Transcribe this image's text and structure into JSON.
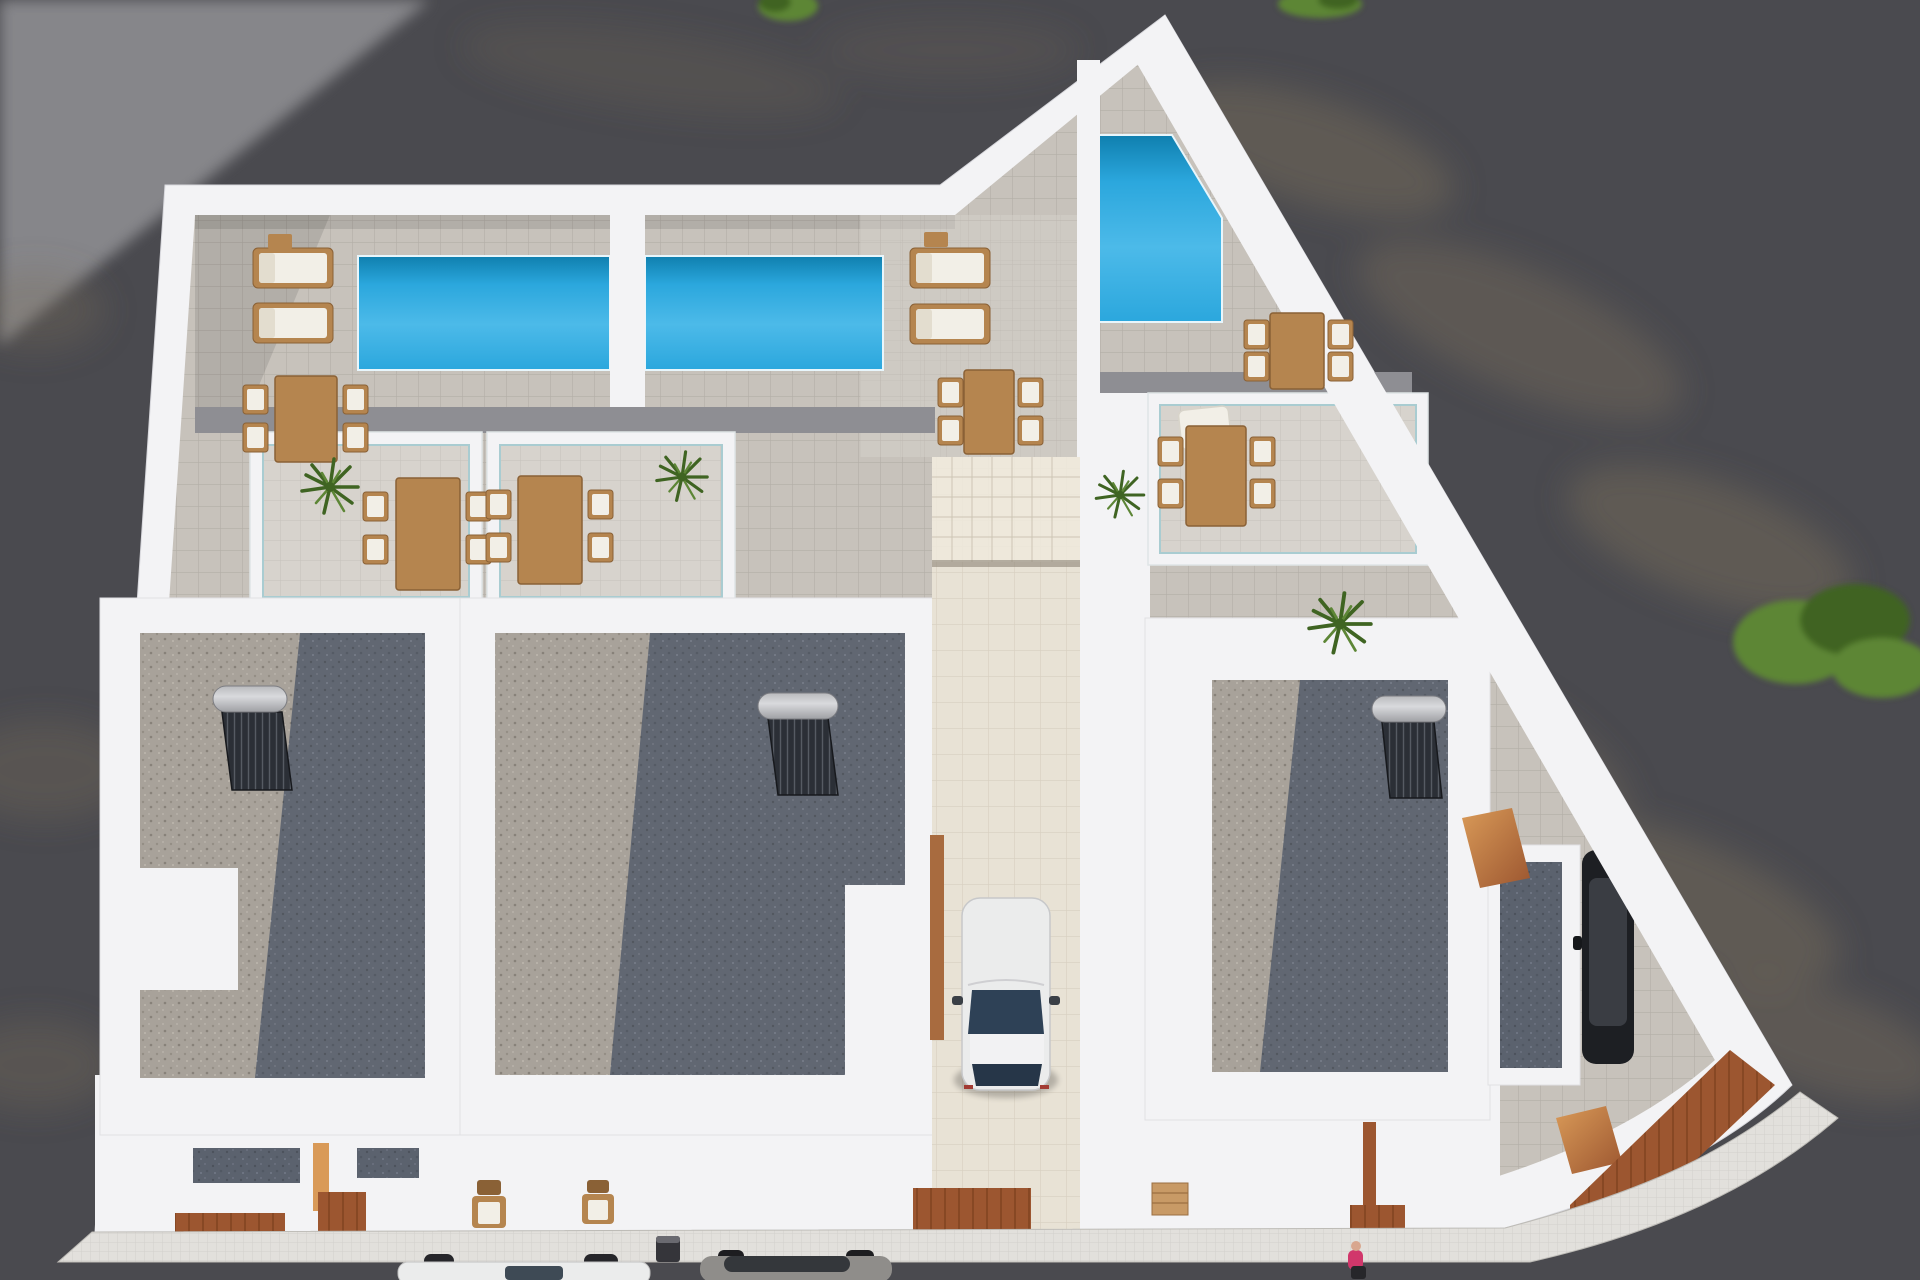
{
  "scene": {
    "title": "Aerial 3D render of seafront villa development",
    "description": "Top-down 3D architectural render of three modern white villas: three turquoise pools on tiled roof terraces with wooden sun loungers and dining sets, gravel flat roofs with solar water heaters, a central driveway with a parked white car, sunken glass-railed patios with palms, terracotta decks, a sidewalk with parked cars and a pedestrian in pink, all surrounded by dark tree-shadowed ground",
    "inventory": {
      "villas": 3,
      "pools": 3,
      "sun_loungers": 4,
      "dining_sets": 7,
      "solar_water_heaters": 3,
      "potted_palms": 4,
      "green_bushes": 3,
      "driveway_cars": 1,
      "street_cars": 2,
      "corner_parked_cars": 1,
      "pedestrians": 1,
      "trash_bins": 1
    },
    "palette": {
      "ground": "#4a4a4f",
      "ground_light": "#8d8d91",
      "dapple": "#7b6e5c",
      "wall": "#f3f3f5",
      "wall_shade": "#e2e2e6",
      "tile": "#c7c2bb",
      "tile_line": "#b3aea7",
      "tile_light": "#d7d3cd",
      "tile_light_line": "#c6c2bb",
      "parapet": "#8e8e93",
      "pool_deep": "#0f7fae",
      "pool": "#2ba7dd",
      "pool_light": "#4cbae9",
      "gravel_light": "#a8a29a",
      "gravel_dark": "#5b626e",
      "wood": "#b5854f",
      "wood_dark": "#8a6136",
      "cushion": "#f2efe7",
      "terracotta": "#9c5630",
      "terracotta_light": "#d99a58",
      "drive": "#e8e2d5",
      "drive_line": "#d7cfc0",
      "sidewalk": "#e2e0dc",
      "sidewalk_line": "#cfcdc8",
      "car_white": "#ebecec",
      "glass": "#2e4156",
      "street_car_gray": "#8f8d8a",
      "glass_dark": "#34373b",
      "black_car": "#1d1f23",
      "green": "#5d8636",
      "green_dark": "#3f6422",
      "pink": "#d1376b",
      "silver": "#d9dadd",
      "panel": "#2b2f36"
    }
  }
}
